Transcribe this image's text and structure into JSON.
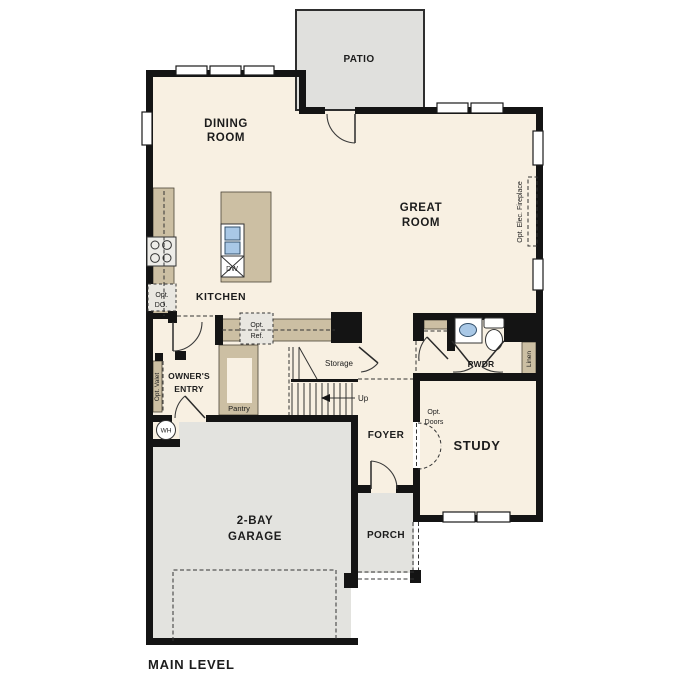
{
  "colors": {
    "background": "#ffffff",
    "floor": "#f8f0e2",
    "outdoor": "#e3e3df",
    "patio": "#e0e0dd",
    "counter": "#ccbfa3",
    "wall": "#141414",
    "appliance": "#edece8",
    "optional_box": "#e9e7e1",
    "sink_blue": "#a9c8e6",
    "text": "#1c1c1c"
  },
  "rooms": {
    "patio": {
      "label": "PATIO"
    },
    "dining_room": {
      "lines": [
        "DINING",
        "ROOM"
      ]
    },
    "great_room": {
      "lines": [
        "GREAT",
        "ROOM"
      ]
    },
    "kitchen": {
      "label": "KITCHEN"
    },
    "owners_entry": {
      "lines": [
        "OWNER'S",
        "ENTRY"
      ]
    },
    "pantry": {
      "label": "Pantry"
    },
    "storage": {
      "label": "Storage"
    },
    "foyer": {
      "label": "FOYER"
    },
    "powder_room": {
      "label": "PWDR"
    },
    "study": {
      "label": "STUDY"
    },
    "porch": {
      "label": "PORCH"
    },
    "garage": {
      "lines": [
        "2-BAY",
        "GARAGE"
      ]
    }
  },
  "annotations": {
    "opt_double_oven": {
      "lines": [
        "Opt.",
        "DO."
      ]
    },
    "opt_refrigerator": {
      "lines": [
        "Opt.",
        "Ref."
      ]
    },
    "opt_valet": {
      "label": "Opt. Valet"
    },
    "opt_electric_fireplace": {
      "label": "Opt. Elec. Fireplace"
    },
    "opt_doors": {
      "lines": [
        "Opt.",
        "Doors"
      ]
    },
    "linen": {
      "label": "Linen"
    },
    "stairs_up": {
      "label": "Up"
    },
    "water_heater": {
      "label": "WH"
    },
    "dishwasher": {
      "label": "DW"
    }
  },
  "footer": {
    "plan_level_label": "MAIN LEVEL"
  }
}
